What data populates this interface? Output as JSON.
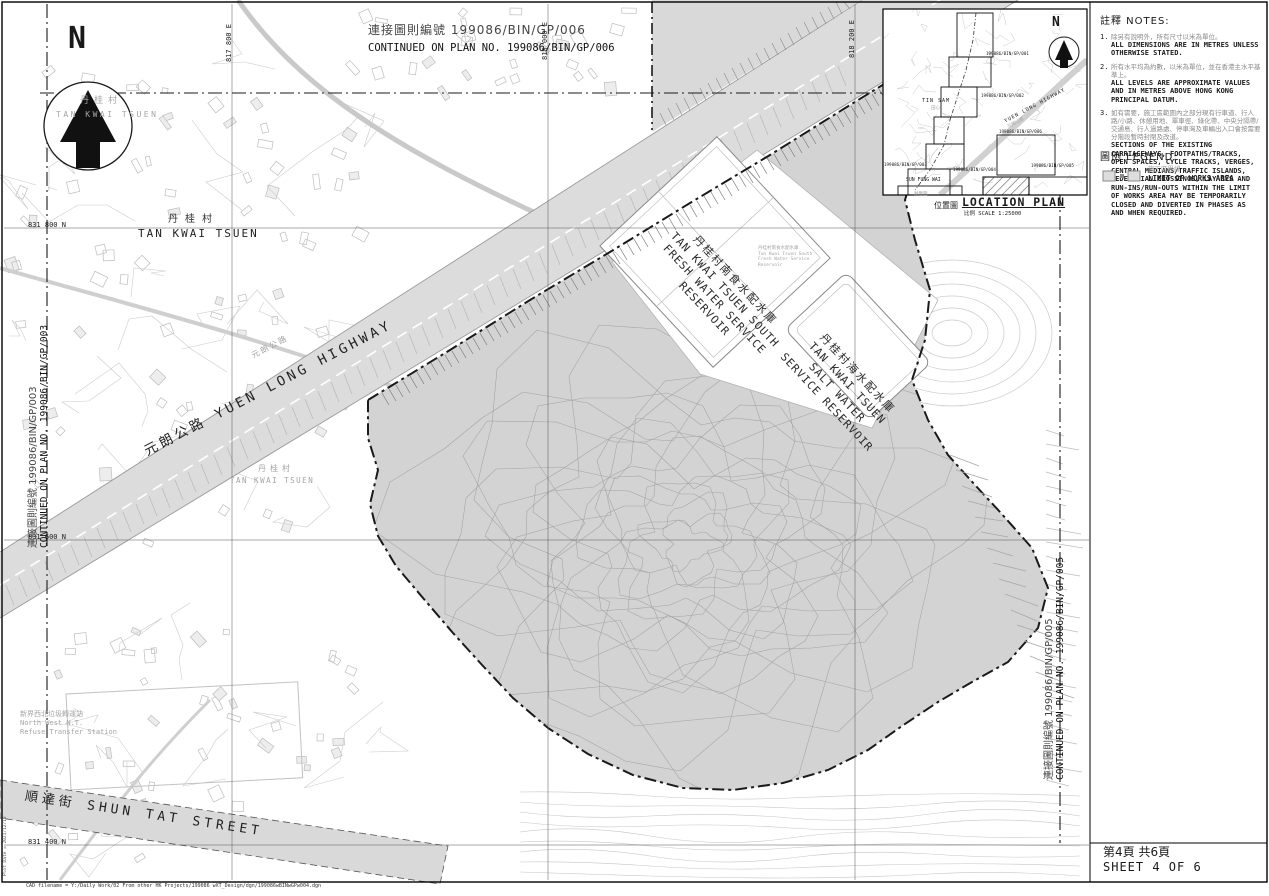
{
  "colors": {
    "works_fill": "#d3d3d3",
    "highway_fill": "#dcdcdc",
    "boundary": "#1a1a1a",
    "texture_gray": "#c3c3c3",
    "label_gray": "#a5a5a5"
  },
  "compass": {
    "north_label": "N"
  },
  "grid": {
    "eastings": [
      "817 800 E",
      "818 000 E",
      "818 200 E"
    ],
    "northings": [
      "831 800 N",
      "831 600 N",
      "831 400 N"
    ]
  },
  "continuations": {
    "top_zh": "連接圖則編號 199086/BIN/GP/006",
    "top_en": "CONTINUED ON PLAN NO. 199086/BIN/GP/006",
    "left_zh": "連接圖則編號 199086/BIN/GP/003",
    "left_en": "CONTINUED ON PLAN NO. 199086/BIN/GP/003",
    "right_zh": "連接圖則編號 199086/BIN/GP/005",
    "right_en": "CONTINUED ON PLAN NO. 199086/BIN/GP/005"
  },
  "map_labels": {
    "village_zh": "丹桂村",
    "village_en": "TAN KWAI TSUEN",
    "highway": "元朗公路 YUEN LONG HIGHWAY",
    "highway_zh": "元朗公路",
    "street": "順達街 SHUN TAT STREET",
    "refuse_zh": "新界西北垃圾轉運站",
    "refuse_en1": "North West N.T.",
    "refuse_en2": "Refuse Transfer Station",
    "fresh_zh": "丹桂村南食水配水庫",
    "fresh_en1": "TAN KWAI TSUEN SOUTH",
    "fresh_en2": "FRESH WATER SERVICE",
    "fresh_en3": "RESERVOIR",
    "fresh_small_zh": "丹桂村南食水配水庫",
    "fresh_small_en1": "Tan Kwai Tsuen South",
    "fresh_small_en2": "Fresh Water Service",
    "fresh_small_en3": "Reservoir",
    "salt_zh": "丹桂村海水配水庫",
    "salt_en1": "TAN KWAI TSUEN",
    "salt_en2": "SALT WATER",
    "salt_en3": "SERVICE RESERVOIR"
  },
  "notes": {
    "title": "註釋  NOTES:",
    "items": [
      {
        "no": "1.",
        "zh": "除另有說明外，所有尺寸以米為單位。",
        "en": "ALL DIMENSIONS ARE IN METRES UNLESS OTHERWISE STATED."
      },
      {
        "no": "2.",
        "zh": "所有水平均為約數，以米為單位，並在香港主水平基準上。",
        "en": "ALL LEVELS ARE APPROXIMATE VALUES AND IN METRES ABOVE HONG KONG PRINCIPAL DATUM."
      },
      {
        "no": "3.",
        "zh": "如有需要，施工區範圍內之部分現有行車道、行人路/小路、休憩用地、單車徑、綠化帶、中央分隔帶/交通島、行人過路處、停車灣及車輛出入口會按需要分階段暫時封閉及改道。",
        "en": "SECTIONS OF THE EXISTING CARRIAGEWAYS, FOOTPATHS/TRACKS, OPEN SPACES, CYCLE TRACKS, VERGES, CENTRAL MEDIANS/TRAFFIC ISLANDS, PEDESTRIAN CROSSINGS, LAY-BYS AND RUN-INS/RUN-OUTS WITHIN THE LIMIT OF WORKS AREA MAY BE TEMPORARILY CLOSED AND DIVERTED IN PHASES AS AND WHEN REQUIRED."
      }
    ]
  },
  "legend": {
    "title": "圖例 LEGEND:",
    "item_zh": "施工區界線",
    "item_en": "LIMIT OF WORKS AREA"
  },
  "location_plan": {
    "title_zh": "位置圖",
    "title_en": "LOCATION PLAN",
    "scale": "比例 SCALE 1:25000",
    "labels": {
      "tin_sam_en": "TIN SAM",
      "tin_sam_zh": "田心",
      "sun_fung_wai_en": "SUN FUNG WAI",
      "sun_fung_wai_zh": "順豐圍",
      "highway_en": "YUEN LONG HIGHWAY",
      "highway_zh": "元朗公路",
      "north": "N"
    },
    "plans": [
      "199086/BIN/GP/001",
      "199086/BIN/GP/002",
      "199086/BIN/GP/006",
      "199086/BIN/GP/003",
      "199086/BIN/GP/004",
      "199086/BIN/GP/005"
    ]
  },
  "title_block": {
    "sheet_zh": "第4頁 共6頁",
    "sheet_en": "SHEET 4 OF 6"
  },
  "footer": {
    "cad": "CAD filename = Y:/Daily Work/02 From other HK Projects/199086 wXT_Design/dgn/199086wBINwGPw004.dgn",
    "plot": "Plot Date = 2021/12/10"
  }
}
